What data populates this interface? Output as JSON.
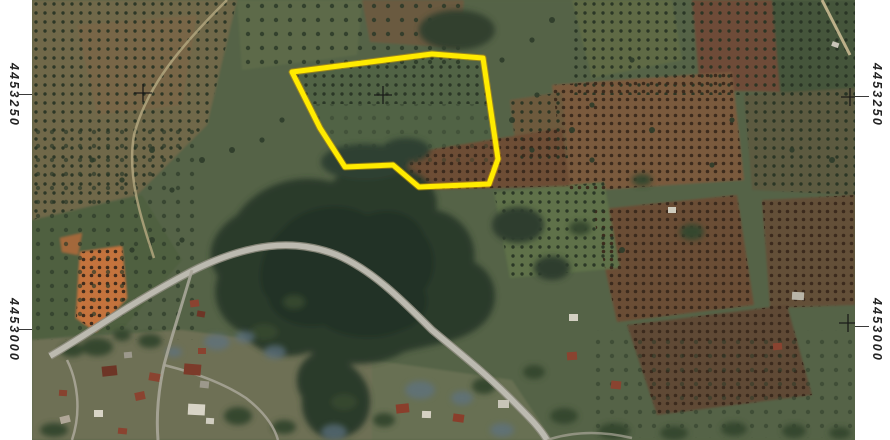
{
  "document": {
    "kind": "orthophoto-map-extract",
    "description": "Aerial/satellite map extract with highlighted land parcel"
  },
  "grid": {
    "northing_top": "4453250",
    "northing_bottom": "4453000",
    "cross_color": "#141414",
    "crosses": [
      {
        "x": 111,
        "y": 93
      },
      {
        "x": 351,
        "y": 95
      },
      {
        "x": 818,
        "y": 97
      },
      {
        "x": 816,
        "y": 323
      }
    ]
  },
  "parcel": {
    "points": "260,72 400,54 451,58 466,159 457,184 387,187 361,165 313,167 288,128",
    "stroke": "#ffeb00",
    "glow": "#d9a400",
    "stroke_width": 5
  },
  "colors": {
    "margin_bg": "#ffffff",
    "base_field": "#556347",
    "forest": "#2c3b2c",
    "orange_field": "#c4733d",
    "road": "#bcbab0",
    "label_color": "#232323"
  }
}
